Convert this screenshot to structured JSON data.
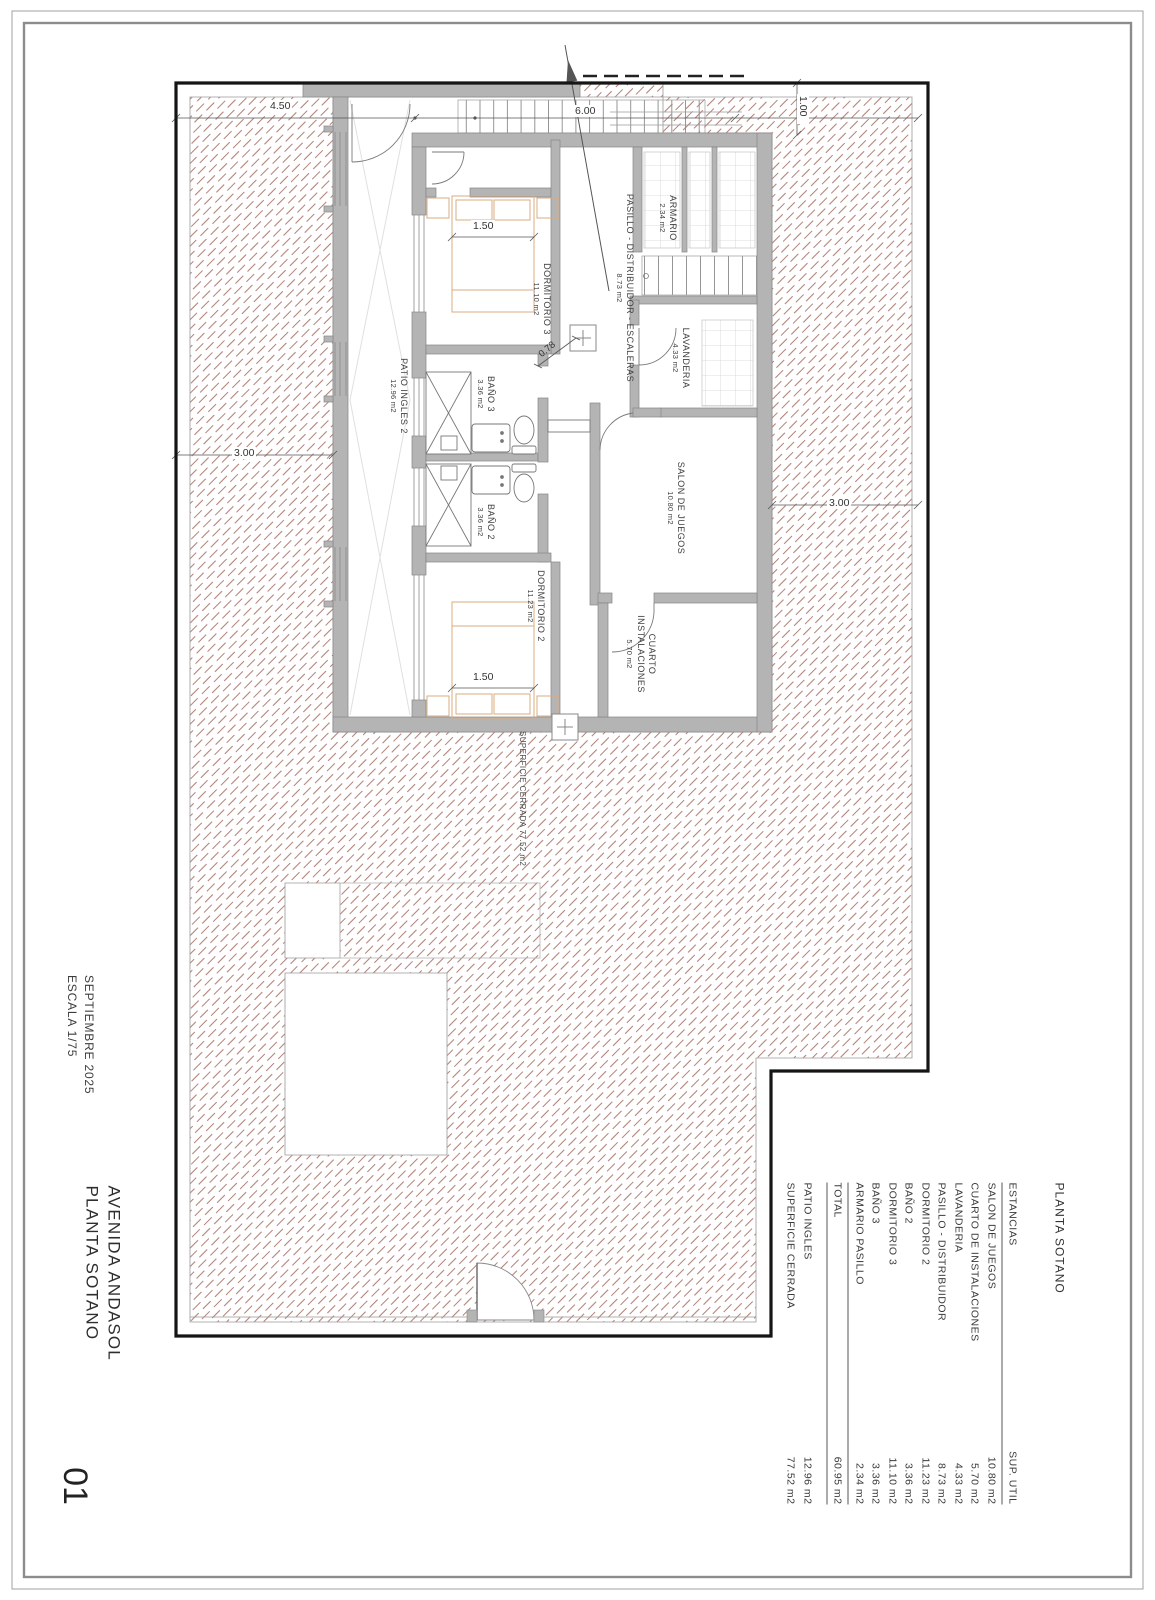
{
  "titleblock": {
    "date": "SEPTIEMBRE 2025",
    "scale": "ESCALA 1/75",
    "project": "AVENIDA ANDASOL",
    "sheet": "PLANTA SOTANO",
    "sheet_number": "01"
  },
  "plan": {
    "rooms": [
      {
        "name": "PASILLO - DISTRIBUIDOR - ESCALERAS",
        "area": "8.73 m2"
      },
      {
        "name": "ARMARIO",
        "area": "2.34 m2"
      },
      {
        "name": "DORMITORIO 3",
        "area": "11.10 m2"
      },
      {
        "name": "BAÑO 3",
        "area": "3.36 m2"
      },
      {
        "name": "BAÑO 2",
        "area": "3.36 m2"
      },
      {
        "name": "LAVANDERIA",
        "area": "4.33 m2"
      },
      {
        "name": "SALON DE JUEGOS",
        "area": "10.80 m2"
      },
      {
        "name": "DORMITORIO 2",
        "area": "11.23 m2"
      },
      {
        "name": "CUARTO",
        "name2": "INSTALACIONES",
        "area": "5.70 m2"
      },
      {
        "name": "PATIO INGLES 2",
        "area": "12.96 m2"
      }
    ],
    "overlay": "SUPERFICIE CERRADA 77.52 m2",
    "dimensions": {
      "d450": "4.50",
      "d600": "6.00",
      "d100": "1.00",
      "d300l": "3.00",
      "d300r": "3.00",
      "d150a": "1.50",
      "d150b": "1.50",
      "d078": "0.78"
    }
  },
  "schedule": {
    "title": "PLANTA SOTANO",
    "col_name": "ESTANCIAS",
    "col_area": "SUP. UTIL",
    "rows": [
      {
        "name": "SALON DE JUEGOS",
        "value": "10.80 m2"
      },
      {
        "name": "CUARTO DE INSTALACIONES",
        "value": "5.70 m2"
      },
      {
        "name": "LAVANDERIA",
        "value": "4.33 m2"
      },
      {
        "name": "PASILLO - DISTRIBUIDOR",
        "value": "8.73 m2"
      },
      {
        "name": "DORMITORIO 2",
        "value": "11.23 m2"
      },
      {
        "name": "BAÑO 2",
        "value": "3.36 m2"
      },
      {
        "name": "DORMITORIO 3",
        "value": "11.10 m2"
      },
      {
        "name": "BAÑO 3",
        "value": "3.36 m2"
      },
      {
        "name": "ARMARIO PASILLO",
        "value": "2.34 m2"
      }
    ],
    "total": {
      "name": "TOTAL",
      "value": "60.95 m2"
    },
    "extras": [
      {
        "name": "PATIO INGLES",
        "value": "12.96 m2"
      },
      {
        "name": "SUPERFICIE CERRADA",
        "value": "77.52 m2"
      }
    ]
  },
  "colors": {
    "hatch": "#b28379",
    "wall": "#b4b4b4",
    "boundary": "#151515",
    "furniture": "#d8ad82"
  }
}
